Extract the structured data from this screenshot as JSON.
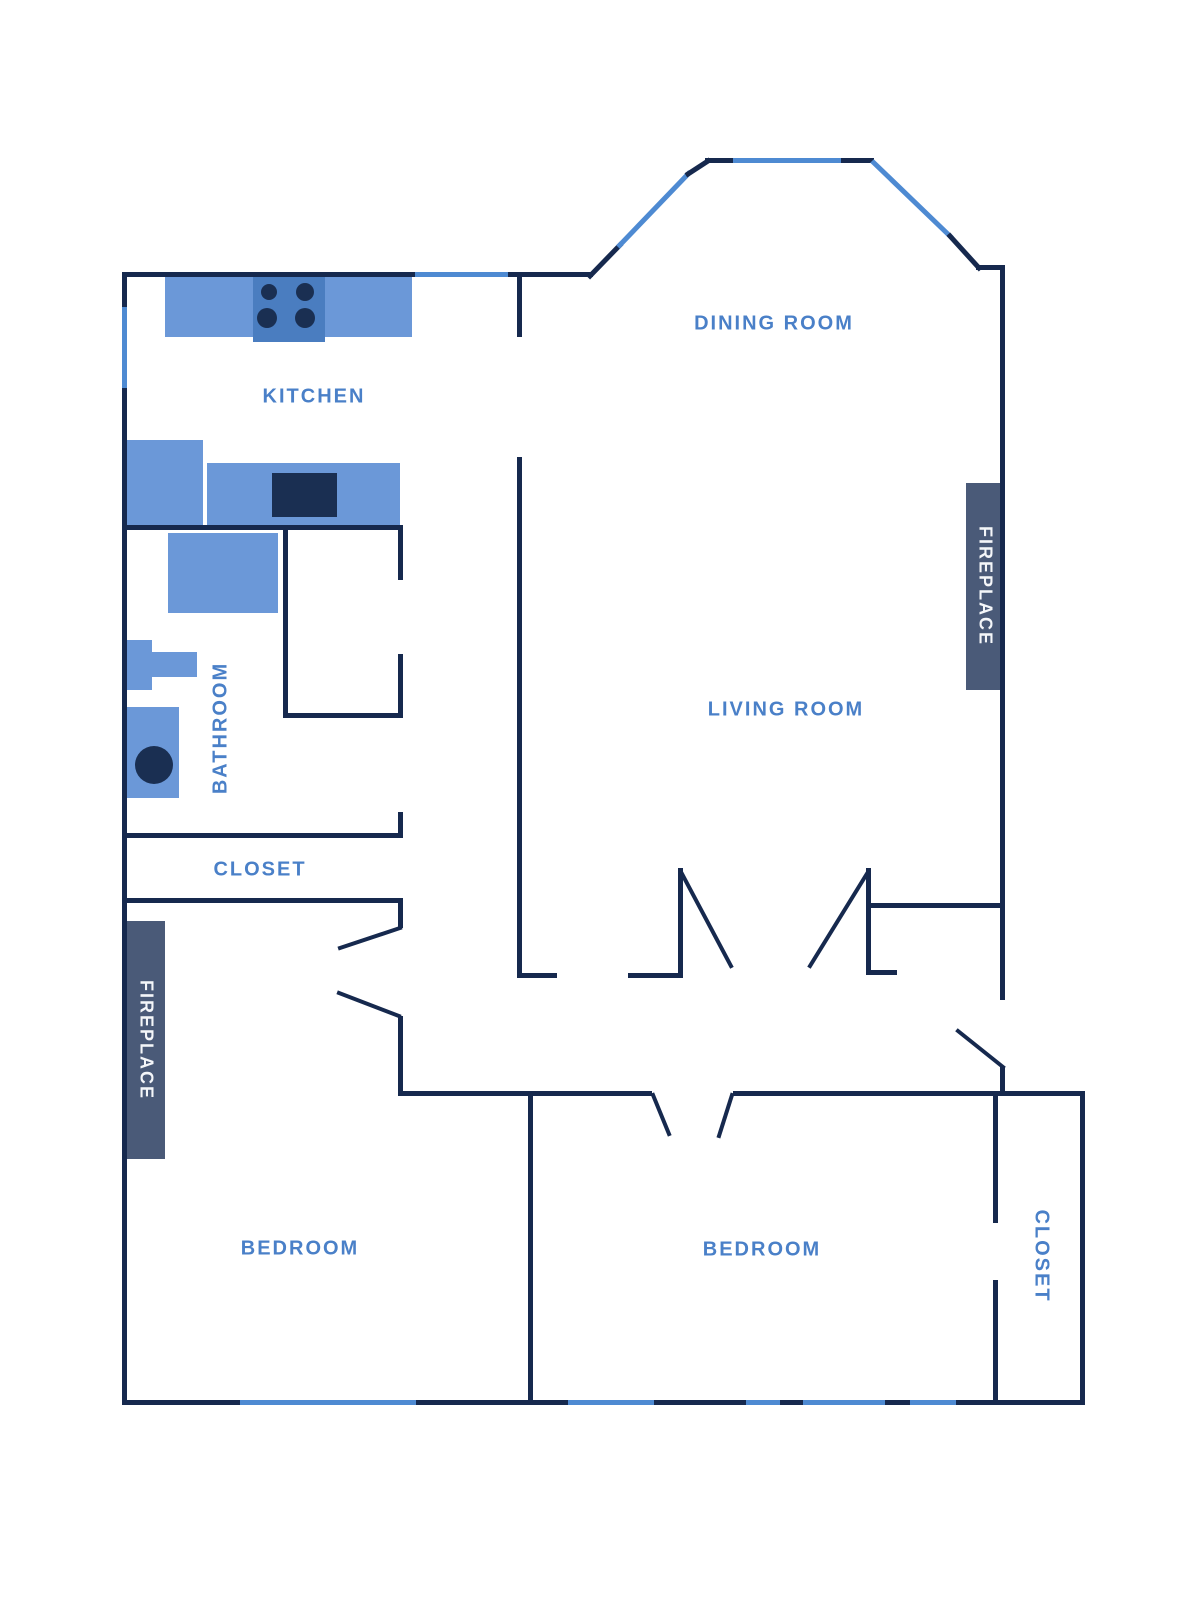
{
  "title": "Apartment floor plan",
  "colors": {
    "background": "#ffffff",
    "wall": "#16294e",
    "window": "#4e8ad2",
    "label": "#4a80c8",
    "furniture": "#6b98d8",
    "furniture_dark": "#4a7dc0",
    "fixture_dark": "#1a2f52",
    "fireplace": "#4a5a78",
    "fireplace_label": "#f4f6f9"
  },
  "rooms": {
    "kitchen": {
      "label": "KITCHEN"
    },
    "dining": {
      "label": "DINING ROOM"
    },
    "living": {
      "label": "LIVING ROOM"
    },
    "bathroom": {
      "label": "BATHROOM"
    },
    "closet_upper": {
      "label": "CLOSET"
    },
    "closet_right": {
      "label": "CLOSET"
    },
    "bedroom_left": {
      "label": "BEDROOM"
    },
    "bedroom_right": {
      "label": "BEDROOM"
    },
    "fireplace_left": {
      "label": "FIREPLACE"
    },
    "fireplace_right": {
      "label": "FIREPLACE"
    }
  }
}
